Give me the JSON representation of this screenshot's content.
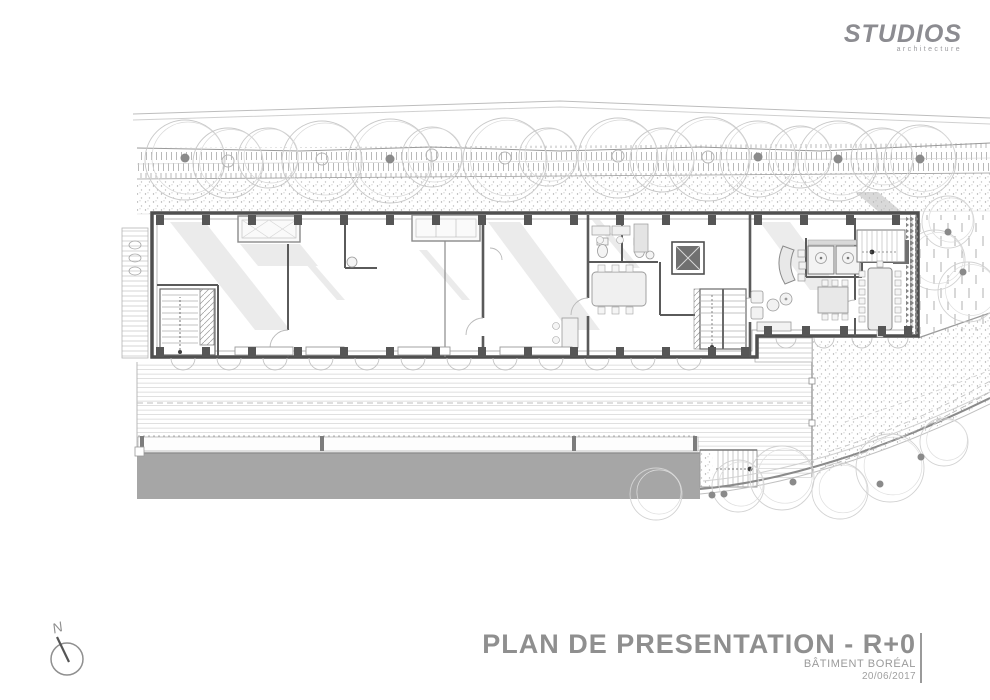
{
  "logo": {
    "name": "STUDIOS",
    "tagline": "architecture"
  },
  "title_block": {
    "title": "PLAN DE PRESENTATION - R+0",
    "subtitle": "BÂTIMENT BORÉAL",
    "date": "20/06/2017"
  },
  "north": {
    "label": "N"
  },
  "colors": {
    "line_light": "#c6c6c6",
    "line_mid": "#9a9a9a",
    "wall_dark": "#4f4f4f",
    "gray_band": "#a6a6a6",
    "text_gray": "#8f8f8f",
    "logo_gray": "#8c8c91",
    "tree_line": "#c9c9c9",
    "dot_dark": "#8a8a8a",
    "column_fill": "#565656"
  },
  "site": {
    "trees_top": [
      [
        185,
        160,
        40,
        "dot"
      ],
      [
        228,
        163,
        35,
        "ring"
      ],
      [
        268,
        158,
        30,
        "none"
      ],
      [
        322,
        161,
        40,
        "ring"
      ],
      [
        390,
        161,
        42,
        "dot"
      ],
      [
        432,
        157,
        30,
        "ring"
      ],
      [
        505,
        160,
        42,
        "ring"
      ],
      [
        548,
        157,
        29,
        "none"
      ],
      [
        618,
        158,
        40,
        "ring"
      ],
      [
        662,
        160,
        32,
        "none"
      ],
      [
        708,
        159,
        42,
        "ring"
      ],
      [
        758,
        159,
        38,
        "dot"
      ],
      [
        800,
        157,
        31,
        "none"
      ],
      [
        838,
        161,
        40,
        "dot"
      ],
      [
        882,
        159,
        31,
        "none"
      ],
      [
        920,
        161,
        36,
        "dot"
      ]
    ],
    "trees_other": [
      [
        656,
        494,
        26
      ],
      [
        738,
        486,
        26
      ],
      [
        782,
        478,
        32
      ],
      [
        840,
        491,
        28
      ],
      [
        890,
        468,
        34
      ],
      [
        944,
        442,
        24
      ],
      [
        935,
        260,
        30
      ],
      [
        948,
        222,
        26
      ],
      [
        968,
        292,
        30
      ]
    ],
    "tree_dots": [
      [
        712,
        495
      ],
      [
        724,
        494
      ],
      [
        793,
        482
      ],
      [
        880,
        484
      ],
      [
        921,
        457
      ],
      [
        948,
        232
      ],
      [
        963,
        272
      ]
    ],
    "columns_top": [
      160,
      206,
      252,
      298,
      344,
      390,
      436,
      482,
      528,
      574,
      620,
      666,
      712,
      758,
      804,
      850,
      896
    ],
    "columns_bottom_main": [
      160,
      206,
      252,
      298,
      344,
      390,
      436,
      482,
      528,
      574,
      620,
      666,
      712,
      745
    ],
    "columns_bottom_right": [
      768,
      806,
      844,
      882,
      908
    ],
    "south_arc_xs": [
      183,
      229,
      275,
      321,
      367,
      413,
      459,
      505,
      551,
      597,
      643,
      689
    ],
    "south_arc_right_xs": [
      786,
      824,
      862,
      898
    ]
  }
}
